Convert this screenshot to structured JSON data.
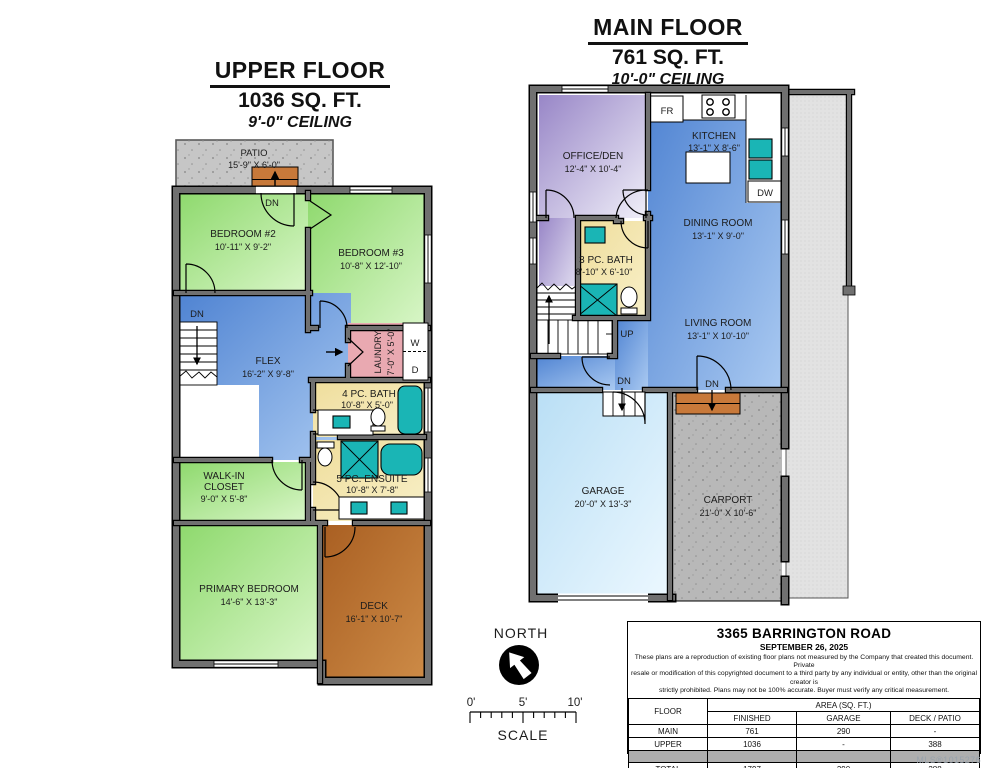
{
  "upper": {
    "title": "UPPER FLOOR",
    "sqft": "1036 SQ. FT.",
    "ceiling": "9'-0\" CEILING",
    "patio": {
      "name": "PATIO",
      "dim": "15'-9\" X 6'-0\""
    },
    "bedroom2": {
      "name": "BEDROOM #2",
      "dim": "10'-11\" X 9'-2\""
    },
    "bedroom3": {
      "name": "BEDROOM #3",
      "dim": "10'-8\" X 12'-10\""
    },
    "flex": {
      "name": "FLEX",
      "dim": "16'-2\" X 9'-8\""
    },
    "laundry": {
      "name": "LAUNDRY",
      "dim": "7'-0\" X 5'-0\""
    },
    "bath4": {
      "name": "4 PC. BATH",
      "dim": "10'-8\" X 5'-0\""
    },
    "ensuite": {
      "name": "5 PC. ENSUITE",
      "dim": "10'-8\" X 7'-8\""
    },
    "closet": {
      "line1": "WALK-IN",
      "line2": "CLOSET",
      "dim": "9'-0\" X 5'-8\""
    },
    "primary": {
      "name": "PRIMARY BEDROOM",
      "dim": "14'-6\" X 13'-3\""
    },
    "deck": {
      "name": "DECK",
      "dim": "16'-1\" X 10'-7\""
    },
    "dn_patio": "DN",
    "dn_stairs": "DN",
    "washer": "W",
    "dryer": "D"
  },
  "main": {
    "title": "MAIN FLOOR",
    "sqft": "761 SQ. FT.",
    "ceiling": "10'-0\" CEILING",
    "office": {
      "name": "OFFICE/DEN",
      "dim": "12'-4\" X 10'-4\""
    },
    "kitchen": {
      "name": "KITCHEN",
      "dim": "13'-1\" X 8'-6\""
    },
    "dining": {
      "name": "DINING ROOM",
      "dim": "13'-1\" X 9'-0\""
    },
    "bath3": {
      "name": "3 PC. BATH",
      "dim": "8'-10\" X 6'-10\""
    },
    "living": {
      "name": "LIVING ROOM",
      "dim": "13'-1\" X 10'-10\""
    },
    "garage": {
      "name": "GARAGE",
      "dim": "20'-0\" X 13'-3\""
    },
    "carport": {
      "name": "CARPORT",
      "dim": "21'-0\" X 10'-6\""
    },
    "fridge": "FR",
    "dishwasher": "DW",
    "up": "UP",
    "dn_hall": "DN",
    "dn_front": "DN"
  },
  "compass": {
    "north": "NORTH",
    "scale": "SCALE",
    "tick0": "0'",
    "tick5": "5'",
    "tick10": "10'"
  },
  "info": {
    "address": "3365 BARRINGTON ROAD",
    "date": "SEPTEMBER 26, 2025",
    "disclaimer_1": "These plans are a reproduction of existing floor plans not measured by the Company that created this document.  Private",
    "disclaimer_2": "resale or modification of this copyrighted document to a third party by any individual or entity, other than the original creator is",
    "disclaimer_3": "strictly prohibited. Plans may not be 100% accurate.  Buyer must verify any critical measurement.",
    "table": {
      "floor": "FLOOR",
      "area": "AREA (SQ. FT.)",
      "cols": [
        "FINISHED",
        "GARAGE",
        "DECK / PATIO"
      ],
      "rows": [
        {
          "name": "MAIN",
          "finished": "761",
          "garage": "290",
          "deck": "-"
        },
        {
          "name": "UPPER",
          "finished": "1036",
          "garage": "-",
          "deck": "388"
        },
        {
          "name": "TOTAL",
          "finished": "1797",
          "garage": "290",
          "deck": "388"
        }
      ]
    },
    "mls": "MLS®1015276"
  },
  "colors": {
    "wall_grey": "#707070",
    "bedroom_green": "#8ed96d",
    "room_blue": "#4f83d2",
    "bath_yellow": "#f0df9e",
    "laundry_pink": "#e9a9b1",
    "office_purple": "#9886c7",
    "deck_brown": "#a95f22",
    "garage_blue": "#badff5",
    "carport_grey": "#b8b8b8",
    "patio_grey": "#c6c6c6",
    "fixture_teal": "#1ab5b5"
  }
}
